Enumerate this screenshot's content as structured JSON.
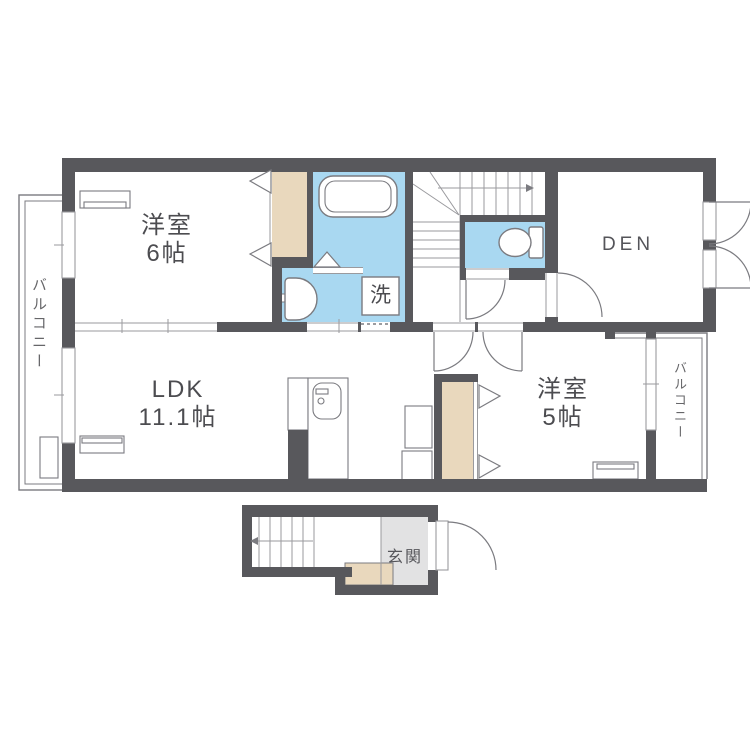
{
  "plan_title": "2F apartment floor plan",
  "rooms": {
    "western6": {
      "name": "洋室",
      "size": "6帖"
    },
    "ldk": {
      "name": "LDK",
      "size": "11.1帖"
    },
    "western5": {
      "name": "洋室",
      "size": "5帖"
    },
    "den": {
      "name": "DEN"
    },
    "entrance": {
      "name": "玄関"
    },
    "laundry": {
      "name": "洗"
    },
    "balcony_left": {
      "name": "バルコニー"
    },
    "balcony_right": {
      "name": "バルコニー"
    }
  },
  "icons": {
    "bathtub": "rounded-rect tub",
    "toilet": "bowl-and-tank",
    "washbasin": "d-shaped basin",
    "kitchen_sink": "counter with sink",
    "air_conditioner": "double rectangle",
    "stairs_up_arrow": "→",
    "stairs_down_arrow": "←",
    "closet_door": "folding-door triangles",
    "door_swing": "quarter-circle arc"
  },
  "colors": {
    "wall": "#58585c",
    "water": "#a9d8f1",
    "closet": "#e9d8bd",
    "entrance_floor": "#e2e2e3",
    "line": "#7b7b80",
    "line_light": "#9a9a9e",
    "text": "#4c4c50",
    "text_soft": "#666669"
  }
}
